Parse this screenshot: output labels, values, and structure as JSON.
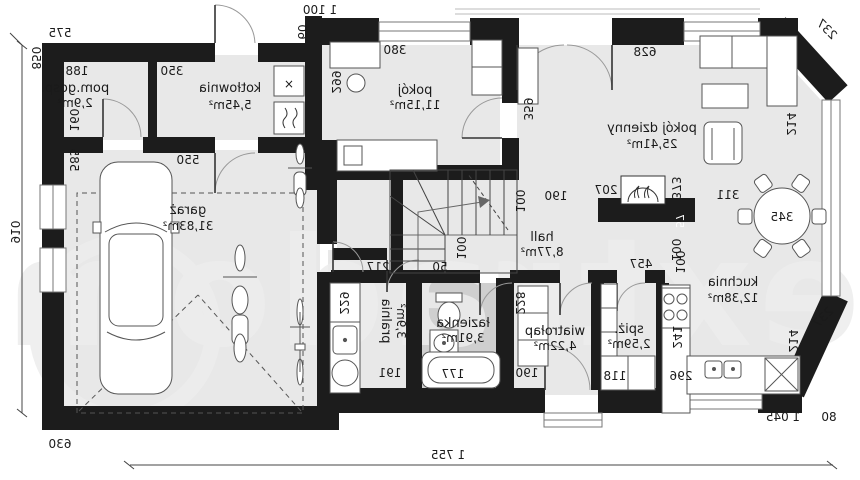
{
  "watermark": "extradom",
  "rooms": {
    "pom_gosp": {
      "name": "pom.gosp.",
      "area": "2,9m²"
    },
    "kotlownia": {
      "name": "kotłownia",
      "area": "5,45m²"
    },
    "garaz": {
      "name": "garaż",
      "area": "31,83m²"
    },
    "pokoj": {
      "name": "pokój",
      "area": "11,15m²"
    },
    "pokoj_dzienny": {
      "name": "pokój dzienny",
      "area": "25,41m²"
    },
    "hall": {
      "name": "hall",
      "area": "8,77m²"
    },
    "kuchnia": {
      "name": "kuchnia",
      "area": "12,38m²"
    },
    "spiz": {
      "name": "spiż.",
      "area": "2,59m²"
    },
    "wiatrolap": {
      "name": "wiatrołap",
      "area": "4,22m²"
    },
    "lazienka": {
      "name": "łazienka",
      "area": "3,91m²"
    },
    "pralnia": {
      "name": "pralnia",
      "area": "3,9m²"
    }
  },
  "dims": {
    "total_width": "1 755",
    "total_height": "910",
    "top_width": "1 100",
    "garage_width": "630",
    "right_width": "1 045",
    "right_edge": "80",
    "left_top": "575",
    "left_wall": "850",
    "annex_offset": "60",
    "pom_gosp_w": "188",
    "pom_gosp_h": "160",
    "kotlownia_w": "350",
    "garaz_w": "550",
    "garaz_h": "585",
    "pokoj_w": "380",
    "pokoj_h": "299",
    "living_w": "628",
    "living_h": "359",
    "bay_top": "237",
    "bay_side_top": "214",
    "bay_bottom": "237",
    "bay_side_bottom": "214",
    "table": "345",
    "table_clear": "311",
    "fireplace_w": "207",
    "fireplace_d": "373",
    "fireplace_wall": "57",
    "fireplace_off": "100",
    "stairs_w": "190",
    "stairs_d": "100",
    "landing": "100",
    "step": "50",
    "pralnia_top": "217",
    "pralnia_counter": "229",
    "pralnia_floor": "191",
    "tub": "177",
    "wardrobe": "228",
    "wiatrolap_w": "190",
    "spiz_w": "118",
    "kitchen_top": "457",
    "kitchen_off": "100",
    "kitchen_counter": "241",
    "kitchen_w": "296"
  },
  "equipment": {
    "x_symbol": "×"
  }
}
